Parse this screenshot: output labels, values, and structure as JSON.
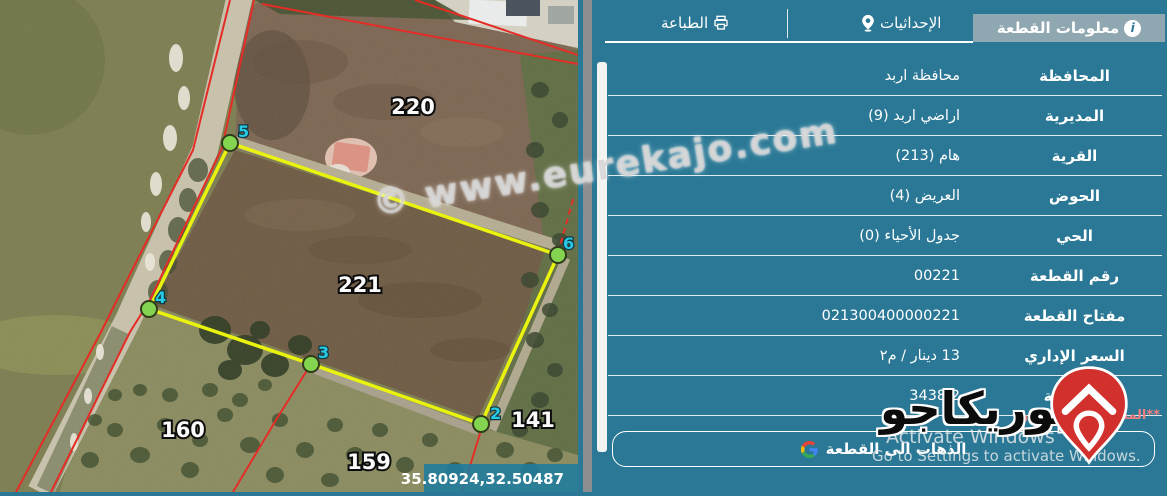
{
  "map": {
    "parcels": [
      {
        "id": "220"
      },
      {
        "id": "221"
      },
      {
        "id": "160"
      },
      {
        "id": "159"
      },
      {
        "id": "141"
      }
    ],
    "vertices": [
      {
        "n": "2"
      },
      {
        "n": "3"
      },
      {
        "n": "4"
      },
      {
        "n": "5"
      },
      {
        "n": "6"
      }
    ],
    "coordinates": "35.80924,32.50487",
    "watermark": "© www.eurekajo.com",
    "colors": {
      "boundary_yellow": "#EDF702",
      "cadastral_red": "#E8221B",
      "vertex_green": "#7FD648",
      "vertex_label_cyan": "#1CCBE8"
    }
  },
  "panel": {
    "tabs": [
      {
        "label": "معلومات القطعة",
        "icon": "info-icon",
        "active": true
      },
      {
        "label": "الإحداثيات",
        "icon": "location-pin-icon",
        "active": false
      },
      {
        "label": "الطباعة",
        "icon": "printer-icon",
        "active": false
      }
    ],
    "rows": [
      {
        "label": "المحافظة",
        "value": "محافظة اربد"
      },
      {
        "label": "المديرية",
        "value": "اراضي اربد (9)"
      },
      {
        "label": "القرية",
        "value": "هام (213)"
      },
      {
        "label": "الحوض",
        "value": "العريض (4)"
      },
      {
        "label": "الحي",
        "value": "جدول الأحياء (0)"
      },
      {
        "label": "رقم القطعة",
        "value": "00221"
      },
      {
        "label": "مفتاح القطعة",
        "value": "021300400000221"
      },
      {
        "label": "السعر الإداري",
        "value": "13 دينار / م٢"
      },
      {
        "label": "المساحة",
        "value": "3438.2"
      }
    ],
    "note": "**المساحة التقريبية و",
    "go_button_label": "الذهاب الى القطعة",
    "colors": {
      "panel_bg": "#2A7895",
      "active_tab_bg": "#8FA7B0",
      "note_red": "#F08080"
    }
  },
  "branding": {
    "logo_text": "يوريكاجو"
  },
  "os_overlay": {
    "line1": "Activate Windows",
    "line2": "Go to Settings to activate Windows."
  }
}
